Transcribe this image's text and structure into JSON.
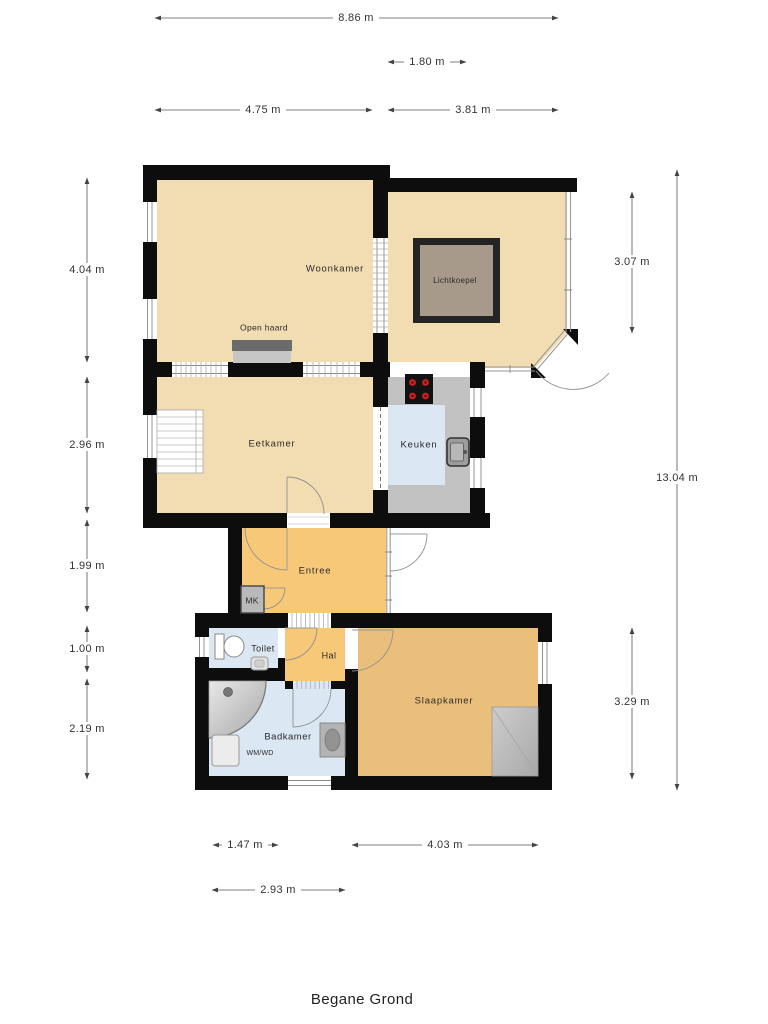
{
  "meta": {
    "title": "Begane Grond",
    "type": "floorplan",
    "floor": "ground"
  },
  "rooms": {
    "woonkamer": "Woonkamer",
    "lichtkoepel": "Lichtkoepel",
    "open_haard": "Open haard",
    "eetkamer": "Eetkamer",
    "keuken": "Keuken",
    "entree": "Entree",
    "mk": "MK",
    "toilet": "Toilet",
    "hal": "Hal",
    "slaapkamer": "Slaapkamer",
    "badkamer": "Badkamer",
    "wmwd": "WM/WD"
  },
  "dimensions": {
    "overall_width": "8.86 m",
    "serre_door_width": "1.80 m",
    "woonkamer_width": "4.75 m",
    "serre_width": "3.81 m",
    "woonkamer_height": "4.04 m",
    "eetkamer_height": "2.96 m",
    "entree_height": "1.99 m",
    "toilet_height": "1.00 m",
    "badkamer_height": "2.19 m",
    "serre_height": "3.07 m",
    "overall_height": "13.04 m",
    "slaapkamer_height": "3.29 m",
    "toilet_width": "1.47 m",
    "slaapkamer_width": "4.03 m",
    "badkamer_block_width": "2.93 m"
  },
  "colors": {
    "wall": "#0d0d0d",
    "floor_living": "#f2dcb2",
    "floor_hall_orange": "#f8c879",
    "floor_bedroom": "#eabf7b",
    "floor_wet_blue": "#dbe7f3",
    "counter_gray": "#c2c2c2",
    "skylight_fill": "#a89a8b",
    "burner_red": "#cc2222"
  }
}
